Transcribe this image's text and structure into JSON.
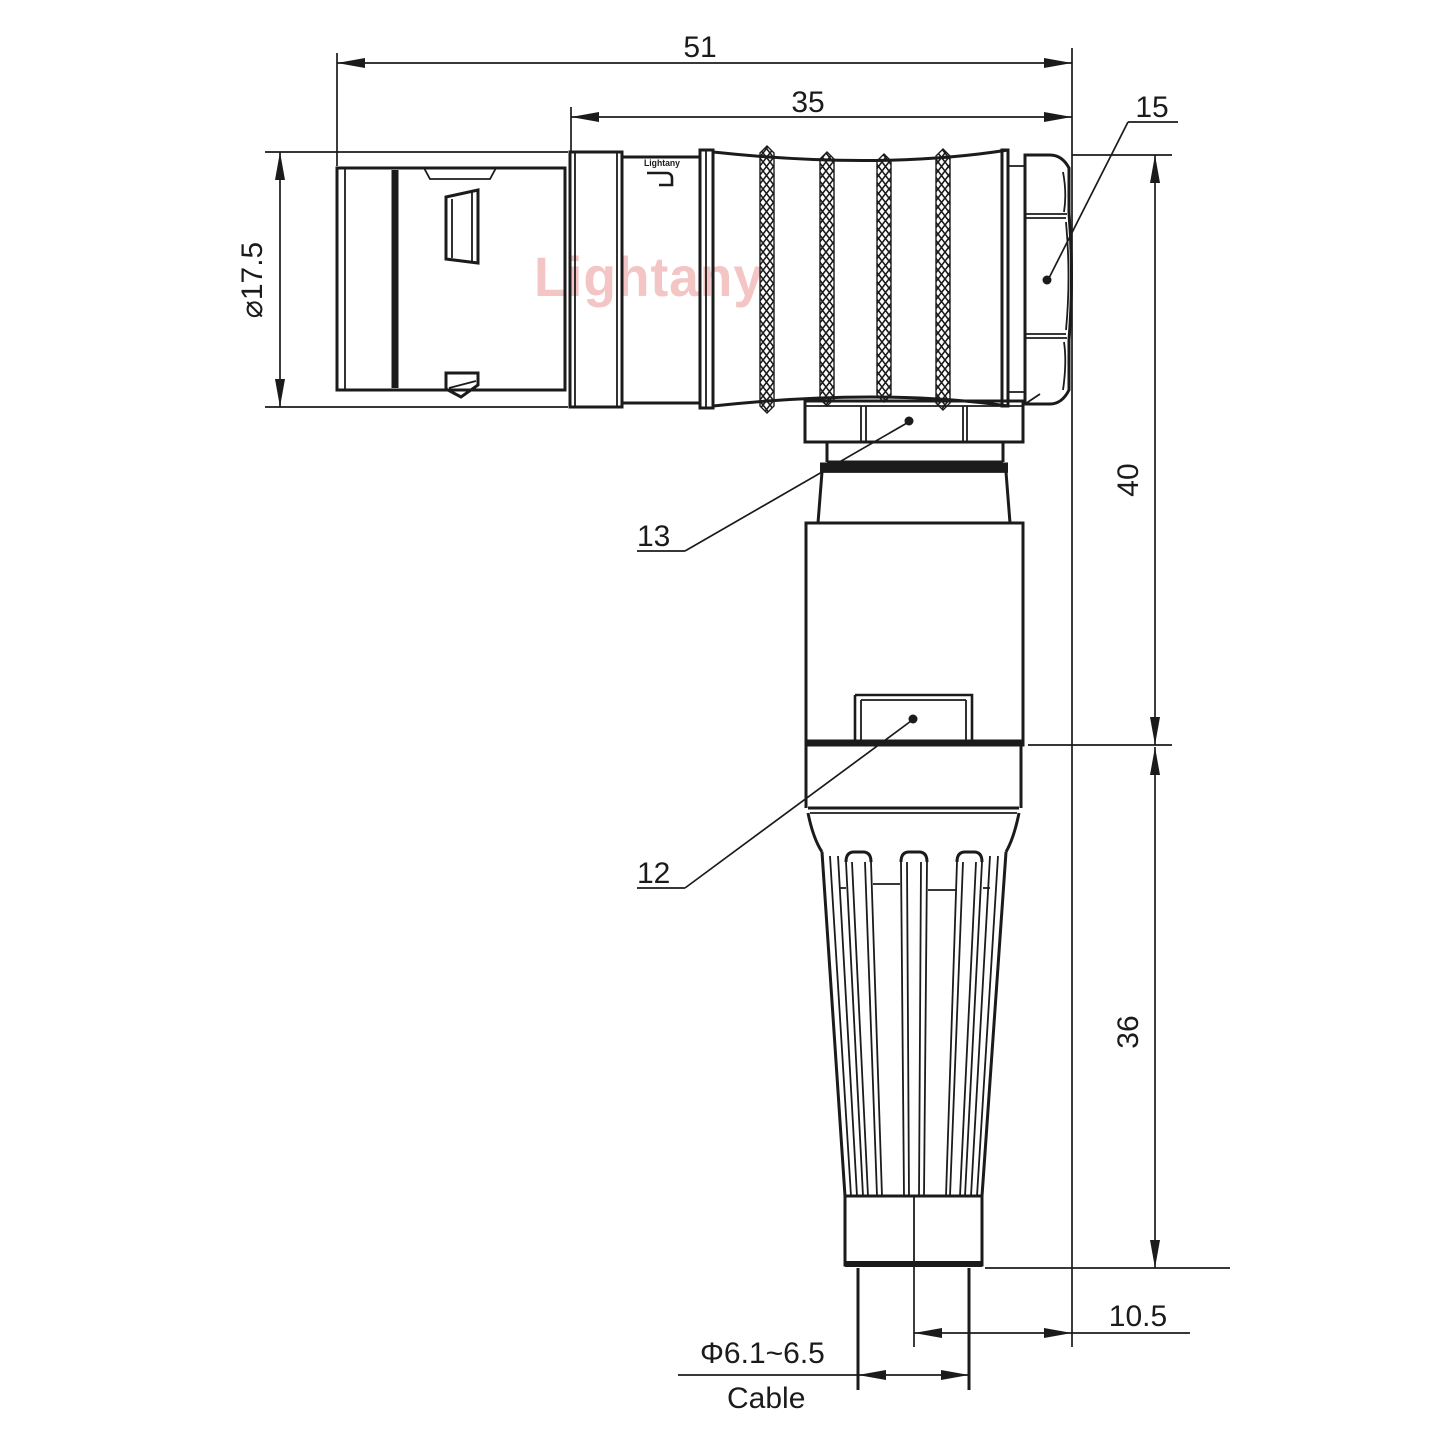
{
  "colors": {
    "line": "#1b1b1b",
    "watermark": "#f3c5c5",
    "background": "#ffffff"
  },
  "watermark": {
    "text": "Lightany"
  },
  "engraving": {
    "text": "Lightany"
  },
  "labels": {
    "overall_length": "51",
    "grip_length": "35",
    "front_diameter": "⌀17.5",
    "height_to_axis": "40",
    "relief_height": "36",
    "axis_offset": "10.5",
    "cable_diameter": "Φ6.1~6.5",
    "cable": "Cable"
  },
  "part_labels": {
    "backnut": "15",
    "coupling_ring": "13",
    "housing": "12"
  }
}
